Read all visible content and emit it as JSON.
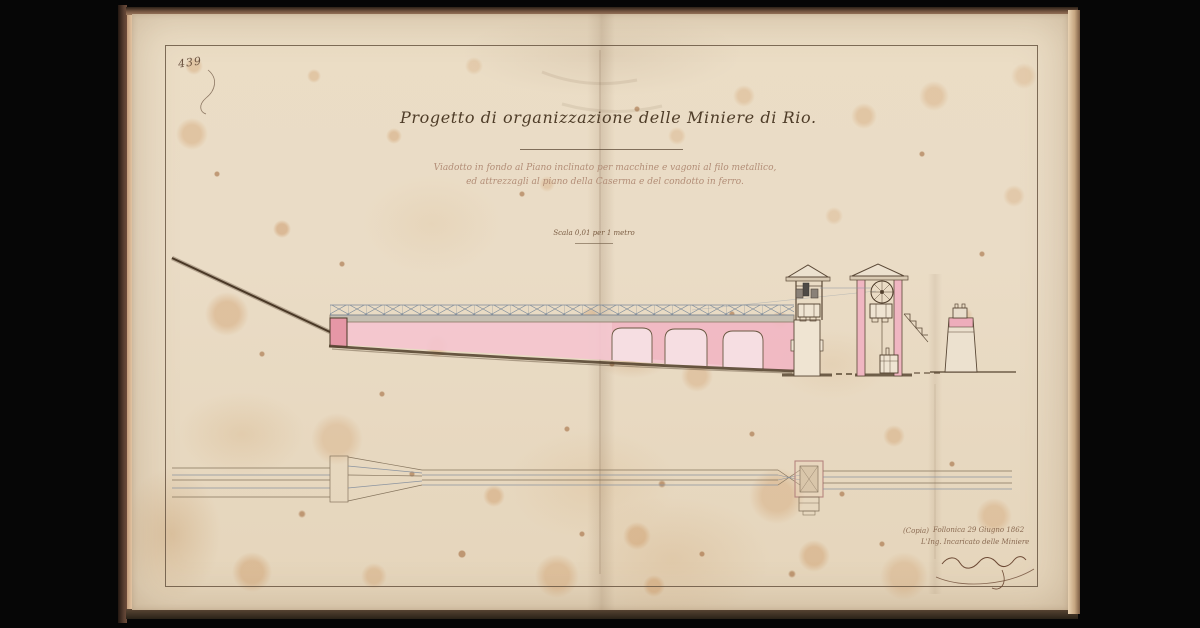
{
  "document": {
    "archive_number": "439",
    "title": "Progetto di organizzazione delle Miniere di Rio.",
    "subtitle_line1": "Viadotto in fondo al Piano inclinato per macchine e vagoni al filo metallico,",
    "subtitle_line2": "ed attrezzagli al piano della Caserma e del condotto in ferro.",
    "scale_note": "Scala 0,01 per 1 metro",
    "signature_block": {
      "copy_note": "(Copia)",
      "place_date": "Follonica 29 Giugno 1862",
      "role": "L'Ing. Incaricato delle Miniere"
    },
    "colors": {
      "paper": "#eadcc6",
      "ink": "#4e3c28",
      "faded_ink": "#b28d77",
      "pink_wash": "#f4c6cf",
      "deep_pink": "#e697a6"
    }
  }
}
